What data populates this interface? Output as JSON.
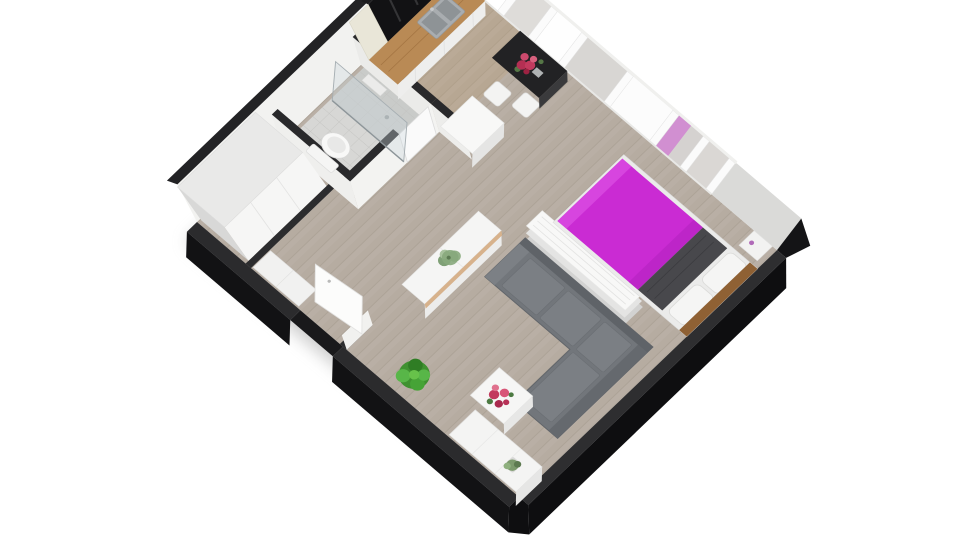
{
  "meta": {
    "title": "3D isometric floor plan render of a studio apartment",
    "view": "axonometric top-down, rotated",
    "background": "#ffffff"
  },
  "rooms": {
    "kitchen": {
      "name": "kitchen",
      "items": [
        "black upper cabinets",
        "cream tall cabinet",
        "wood countertop",
        "double sink",
        "white dining cube table",
        "two white stools",
        "dark breakfast bar",
        "red flower bouquet"
      ]
    },
    "bathroom": {
      "name": "bathroom",
      "items": [
        "toilet",
        "walk-in shower with glass partition",
        "gray tile floor",
        "towel shelf"
      ]
    },
    "hallway": {
      "name": "entry hallway",
      "items": [
        "white wardrobe",
        "entry closet",
        "open white entry door",
        "white sideboard with wood trim",
        "green succulent"
      ]
    },
    "living_area": {
      "name": "living area",
      "items": [
        "gray L-shaped sofa",
        "white coffee table with red flowers",
        "white TV bench with small succulent",
        "green floor plant",
        "white slatted shelf divider"
      ]
    },
    "sleeping_area": {
      "name": "sleeping area",
      "items": [
        "double bed with magenta duvet",
        "dark gray blanket",
        "two white pillows",
        "wood headboard",
        "white nightstand"
      ]
    },
    "facade": {
      "name": "window wall",
      "items": [
        "kitchen window",
        "bar window",
        "bedroom window band with sheer panes",
        "magenta reflection pane"
      ]
    }
  },
  "colors": {
    "background": "#ffffff",
    "floor_wood": "#b6aca1",
    "kitchen_floor_tint": "rgba(190,148,96,0.20)",
    "bathroom_tile": "#d7d7d5",
    "shower_tile": "#c9cbc9",
    "wall_face": "#f2f2f0",
    "wall_top": "#232325",
    "interior_wall_top": "#29292b",
    "outer_wall_dark": "#0e0e10",
    "window_glass_bright": "#ffffff",
    "window_glass_sheer": "#d8d6d3",
    "window_magenta_reflection": "rgba(202,43,211,0.4)",
    "bed_duvet_magenta": "#ca2bd3",
    "bed_blanket_dark": "#48484c",
    "headboard_wood": "#8f6134",
    "sofa_gray": "#72767b",
    "counter_wood": "#b98a55",
    "upper_cabinet_black": "#121214",
    "cabinet_cream": "#e9e6d8",
    "bar_dark": "#222224",
    "plant_green": "#3f9130",
    "flower_red": "#c23a5e",
    "succulent_green": "#87a87c",
    "furniture_white": "#f5f5f4"
  }
}
